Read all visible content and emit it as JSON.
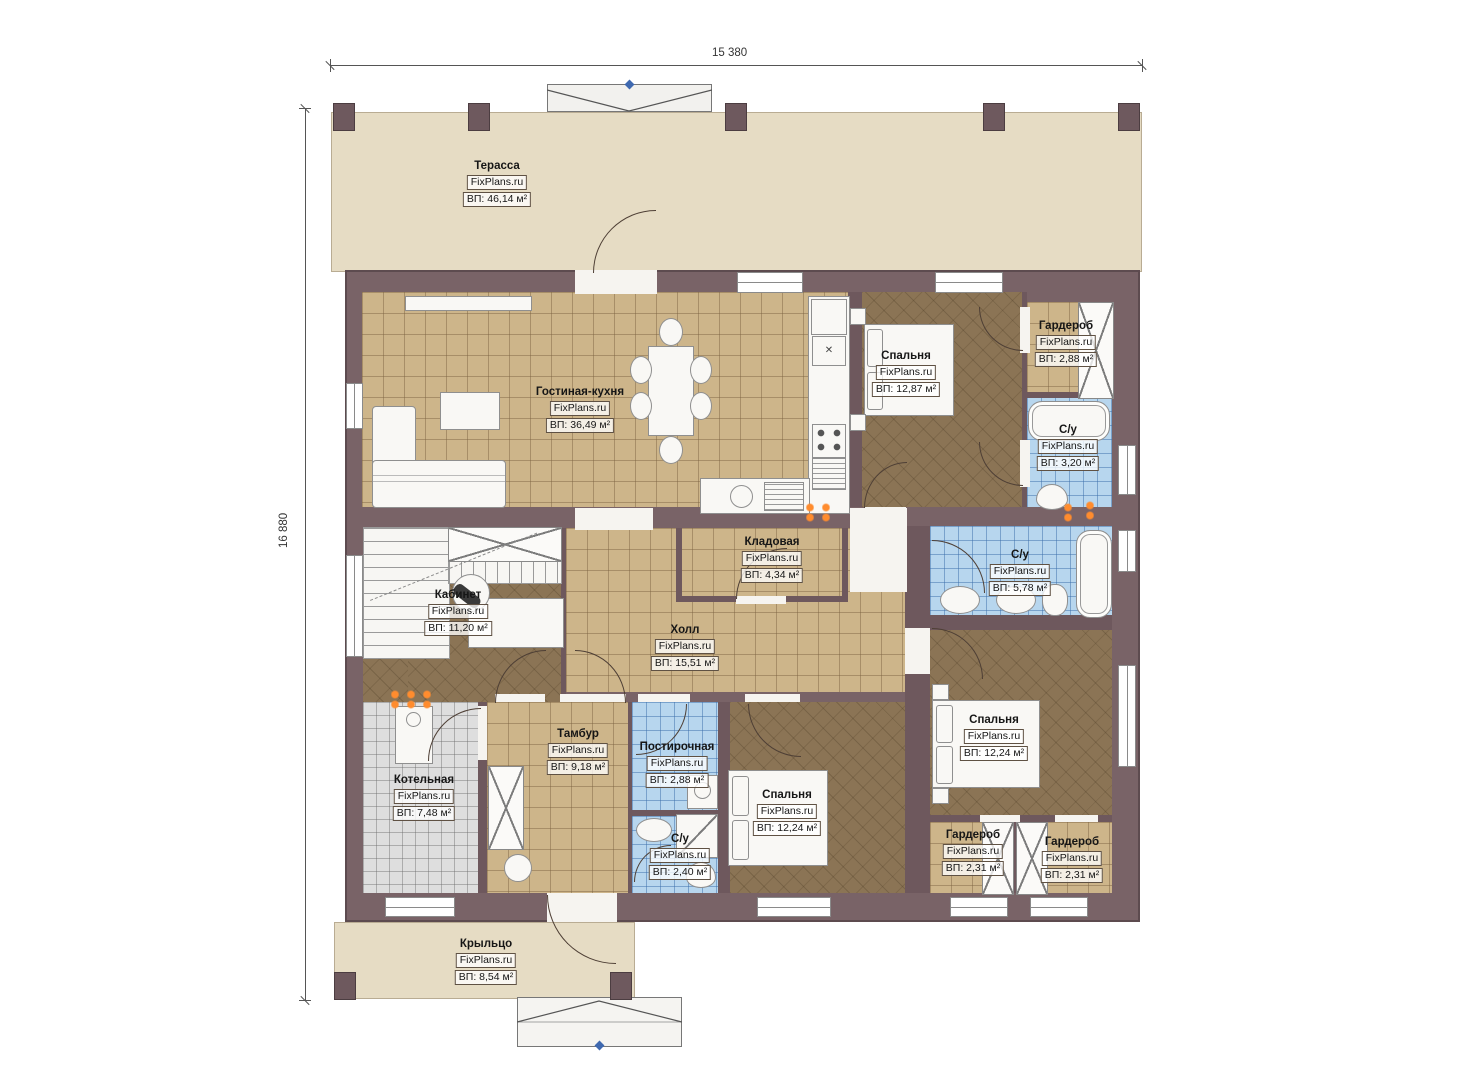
{
  "meta": {
    "type": "floor-plan",
    "source_watermark": "FixPlans.ru"
  },
  "dimensions": {
    "width": "15 380",
    "height": "16 880"
  },
  "colors": {
    "wall": "#796367",
    "floor_tile_tan": "#cdb58a",
    "floor_carpet_dark": "#8b7455",
    "floor_bath_blue": "#b7d6ee",
    "floor_boiler_gray": "#dedede",
    "terrace_beige": "#e6dcc4",
    "outlet_orange": "#ff8c2e",
    "marker_blue": "#3f69b0"
  },
  "rooms": [
    {
      "id": "terrace",
      "name": "Терасса",
      "area": "ВП: 46,14 м²"
    },
    {
      "id": "living-kitchen",
      "name": "Гостиная-кухня",
      "area": "ВП: 36,49 м²"
    },
    {
      "id": "bedroom-top",
      "name": "Спальня",
      "area": "ВП: 12,87 м²"
    },
    {
      "id": "wardrobe-top",
      "name": "Гардероб",
      "area": "ВП: 2,88 м²"
    },
    {
      "id": "bathroom-top",
      "name": "С/у",
      "area": "ВП: 3,20 м²"
    },
    {
      "id": "storage",
      "name": "Кладовая",
      "area": "ВП: 4,34 м²"
    },
    {
      "id": "bathroom-mid",
      "name": "С/у",
      "area": "ВП: 5,78 м²"
    },
    {
      "id": "office",
      "name": "Кабинет",
      "area": "ВП: 11,20 м²"
    },
    {
      "id": "hall",
      "name": "Холл",
      "area": "ВП: 15,51 м²"
    },
    {
      "id": "vestibule",
      "name": "Тамбур",
      "area": "ВП: 9,18 м²"
    },
    {
      "id": "laundry",
      "name": "Постирочная",
      "area": "ВП: 2,88 м²"
    },
    {
      "id": "boiler-room",
      "name": "Котельная",
      "area": "ВП: 7,48 м²"
    },
    {
      "id": "bathroom-bottom",
      "name": "С/у",
      "area": "ВП: 2,40 м²"
    },
    {
      "id": "bedroom-mid",
      "name": "Спальня",
      "area": "ВП: 12,24 м²"
    },
    {
      "id": "bedroom-right",
      "name": "Спальня",
      "area": "ВП: 12,24 м²"
    },
    {
      "id": "wardrobe-bl",
      "name": "Гардероб",
      "area": "ВП: 2,31 м²"
    },
    {
      "id": "wardrobe-br",
      "name": "Гардероб",
      "area": "ВП: 2,31 м²"
    },
    {
      "id": "porch",
      "name": "Крыльцо",
      "area": "ВП: 8,54 м²"
    }
  ]
}
